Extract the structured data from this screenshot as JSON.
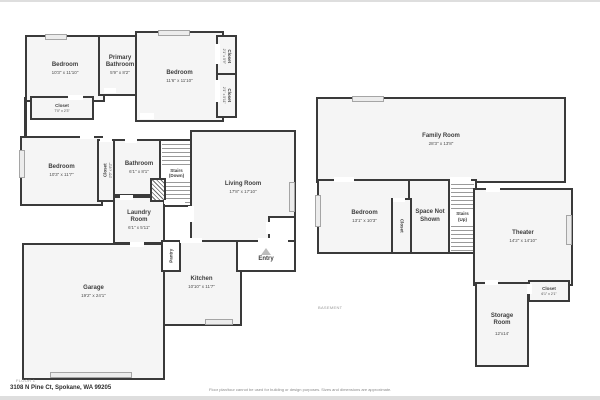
{
  "colors": {
    "wall": "#3a3a3a",
    "room_fill": "#f5f5f5",
    "window_marker": "#ececec",
    "background": "#ffffff"
  },
  "floor1": {
    "caption": "FLOOR 1",
    "rooms": {
      "bedroom1": {
        "name": "Bedroom",
        "dims": "10'3\" x 11'10\""
      },
      "primary_bathroom": {
        "name": "Primary Bathroom",
        "dims": "5'9\" x 8'2\""
      },
      "bedroom2": {
        "name": "Bedroom",
        "dims": "11'6\" x 11'10\""
      },
      "closet_r1": {
        "name": "Closet",
        "dims": "2'1\" x 5'9\""
      },
      "closet_r2": {
        "name": "Closet",
        "dims": "2'1\" x 5'11\""
      },
      "closet_l": {
        "name": "Closet",
        "dims": "7'0\" x 2'3\""
      },
      "bedroom3": {
        "name": "Bedroom",
        "dims": "10'3\" x 11'7\""
      },
      "closet_m": {
        "name": "Closet",
        "dims": "2'6\" x 8'2\""
      },
      "bathroom": {
        "name": "Bathroom",
        "dims": "6'1\" x 8'1\""
      },
      "stairs_down": {
        "name": "Stairs",
        "sub": "(Down)"
      },
      "living_room": {
        "name": "Living Room",
        "dims": "17'8\" x 17'10\""
      },
      "laundry": {
        "name": "Laundry Room",
        "dims": "6'1\" x 5'11\""
      },
      "pantry": {
        "name": "Pantry"
      },
      "entry": {
        "name": "Entry"
      },
      "kitchen": {
        "name": "Kitchen",
        "dims": "10'10\" x 11'7\""
      },
      "garage": {
        "name": "Garage",
        "dims": "19'2\" x 24'1\""
      }
    }
  },
  "basement": {
    "caption": "BASEMENT",
    "rooms": {
      "family_room": {
        "name": "Family Room",
        "dims": "28'3\" x 13'8\""
      },
      "bedroom": {
        "name": "Bedroom",
        "dims": "13'1\" x 10'3\""
      },
      "closet_bed": {
        "name": "Closet"
      },
      "space_not_shown": {
        "name": "Space Not Shown"
      },
      "stairs_up": {
        "name": "Stairs",
        "sub": "(Up)"
      },
      "theater": {
        "name": "Theater",
        "dims": "14'2\" x 14'10\""
      },
      "closet_theater": {
        "name": "Closet",
        "dims": "6'1\" x 2'1\""
      },
      "storage": {
        "name": "Storage Room",
        "dims": "12'x14'"
      }
    }
  },
  "footer": {
    "address": "3108 N Pine Ct, Spokane, WA 99205",
    "disclaimer": "Floor plan/tour cannot be used for building or design purposes. Sizes and dimensions are approximate."
  }
}
